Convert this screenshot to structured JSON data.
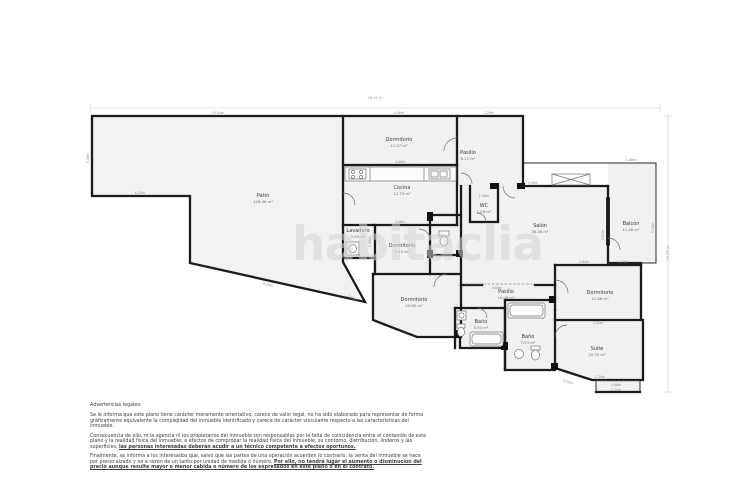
{
  "page": {
    "background": "#ffffff"
  },
  "watermark": {
    "text": "habitaclia"
  },
  "colors": {
    "wall": "#1b1b1b",
    "room_fill": "#f1f1ef",
    "dimension_text": "#8f8f8f",
    "label_text": "#3a3a3a",
    "watermark": "#d4d4d4"
  },
  "plan": {
    "rooms": [
      {
        "name": "Patio",
        "area": "126.46 m²"
      },
      {
        "name": "Dormitorio",
        "area": "11.27 m²"
      },
      {
        "name": "Pasillo",
        "area": "8.22 m²"
      },
      {
        "name": "Cocina",
        "area": "12.73 m²"
      },
      {
        "name": "Lavadero",
        "area": "3.00 m²"
      },
      {
        "name": "Dormitorio",
        "area": "9.42 m²"
      },
      {
        "name": "WC",
        "area": "1.06 m²"
      },
      {
        "name": "Salón",
        "area": "36.46 m²"
      },
      {
        "name": "Balcón",
        "area": "11.46 m²"
      },
      {
        "name": "Dormitorio",
        "area": "20.60 m²"
      },
      {
        "name": "Pasillo",
        "area": "10.06 m²"
      },
      {
        "name": "Baño",
        "area": "5.04 m²"
      },
      {
        "name": "Baño",
        "area": "7.03 m²"
      },
      {
        "name": "Dormitorio",
        "area": "11.86 m²"
      },
      {
        "name": "Suite",
        "area": "20.72 m²"
      }
    ],
    "dims": [
      "36.91 m",
      "20.35 m",
      "19.84m",
      "5.06m",
      "6.29m",
      "8.29m",
      "4.06m",
      "2.29m",
      "4.00m",
      "4.06m",
      "1.06m",
      "3.06m",
      "4.87m",
      "5.74m",
      "1.06m",
      "2.84m",
      "1.74m",
      "4.02m",
      "2.06m",
      "2.75m",
      "1.79m",
      "2.05m",
      "2.90m",
      "4.84m",
      "2.06m"
    ]
  },
  "legal": {
    "heading": "Advertencias legales:",
    "p1": "Se le informa que este plano tiene carácter meramente orientativo, carece de valor legal, no ha sido elaborado para representar de forma gráficamente equivalente la complejidad del inmueble identificado y carece de carácter vinculante respecto a las características del inmueble.",
    "p2_normal": "Consecuencia de ello, ni la agencia ni los propietarios del inmueble son responsables por la falta de coincidencia entre el contenido de este plano y la realidad física del inmueble; a efectos de comprobar la realidad física del inmueble, su contorno, distribución, linderos y las superficies, ",
    "p2_bold": "las personas interesadas deberán acudir a un técnico competente a efectos oportunos.",
    "p3_normal": "Finalmente, se informa a los interesados que, salvo que las partes de una operación acuerden lo contrario, la venta del inmueble se hace por precio alzado y no a razón de un tanto por unidad de medida o número. ",
    "p3_bold": "Por ello, no tendrá lugar el aumento o disminución del precio aunque resulte mayor o menor cabida o número de los expresados en este plano o en el contrato."
  }
}
